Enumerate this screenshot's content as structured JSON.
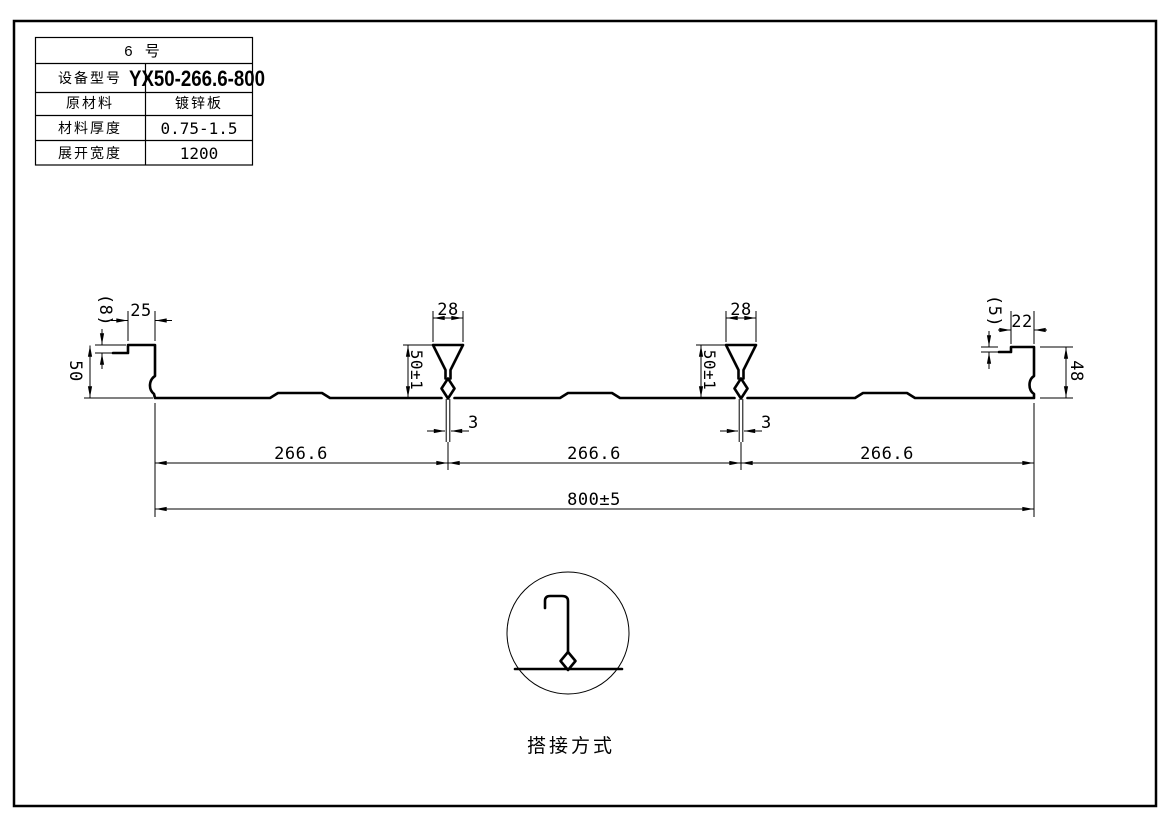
{
  "title_block": {
    "header": "6 号",
    "rows": [
      {
        "label": "设备型号",
        "value": "YX50-266.6-800"
      },
      {
        "label": "原材料",
        "value": "镀锌板"
      },
      {
        "label": "材料厚度",
        "value": "0.75-1.5"
      },
      {
        "label": "展开宽度",
        "value": "1200"
      }
    ]
  },
  "profile_dims": {
    "left_lip_width": "25",
    "left_lip_step": "(8)",
    "left_edge_height": "50",
    "right_lip_width": "22",
    "right_lip_step": "(5)",
    "right_edge_height": "48",
    "ribs": [
      {
        "top_width": "28",
        "height": "50±1",
        "stem_width": "3"
      },
      {
        "top_width": "28",
        "height": "50±1",
        "stem_width": "3"
      }
    ],
    "pitch": [
      "266.6",
      "266.6",
      "266.6"
    ],
    "overall_width": "800±5"
  },
  "lap_detail": {
    "caption": "搭接方式"
  },
  "colors": {
    "line": "#000000",
    "background": "#ffffff"
  }
}
